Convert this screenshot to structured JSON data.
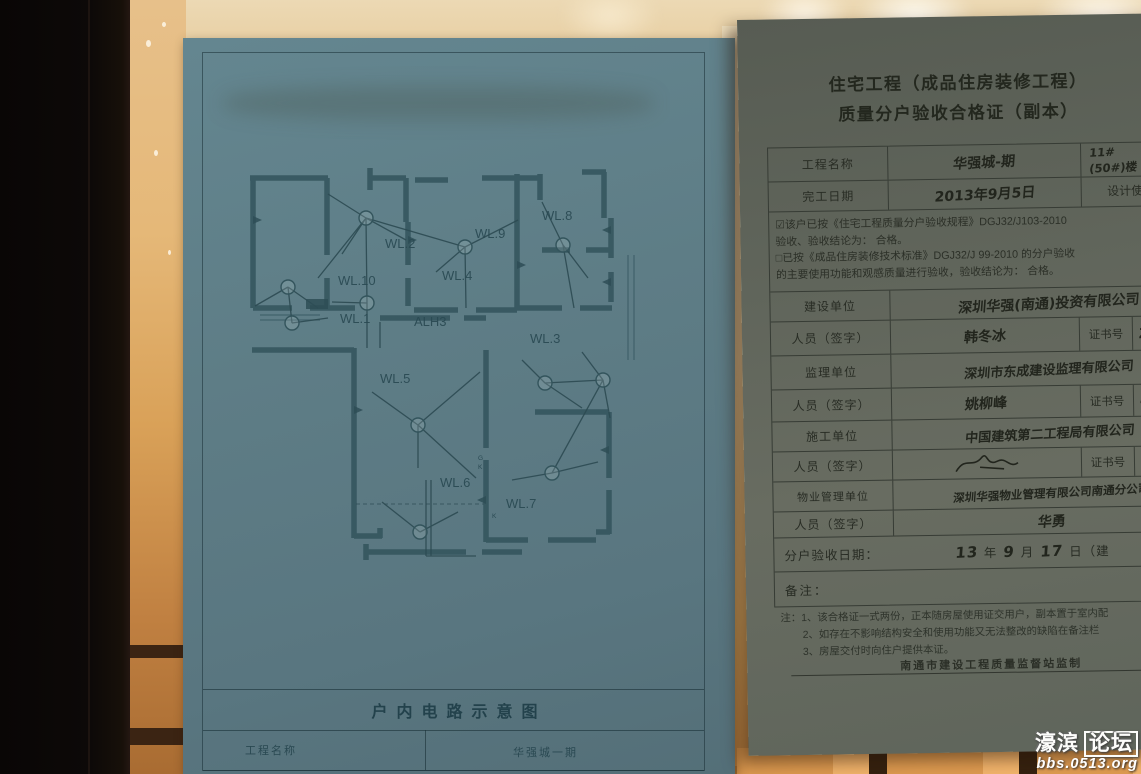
{
  "left_doc": {
    "title": "户内电路示意图",
    "table": {
      "name_label": "工程名称",
      "name_value": "华强城一期"
    },
    "diagram": {
      "labels": [
        {
          "text": "WL.2"
        },
        {
          "text": "WL.9"
        },
        {
          "text": "WL.8"
        },
        {
          "text": "WL.10"
        },
        {
          "text": "WL.4"
        },
        {
          "text": "WL.1"
        },
        {
          "text": "ALH3"
        },
        {
          "text": "WL.3"
        },
        {
          "text": "WL.5"
        },
        {
          "text": "WL.6"
        },
        {
          "text": "WL.7"
        }
      ],
      "marks": {
        "g": "G",
        "k1": "K",
        "k2": "K"
      }
    }
  },
  "right_doc": {
    "title_line1": "住宅工程（成品住房装修工程）",
    "title_line2": "质量分户验收合格证（副本）",
    "rows": {
      "project_label": "工程名称",
      "project_value_hand": "华强城-期",
      "project_unit_line1": "11#",
      "project_unit_line2": "(50#)楼 2 单",
      "finish_label": "完工日期",
      "finish_value_hand": "2013年9月5日",
      "design_life_label": "设计使用年限",
      "builder_label": "建设单位",
      "builder_value_hand": "深圳华强(南通)投资有限公司",
      "person_label": "人员（签字）",
      "builder_person_hand": "韩冬冰",
      "cert_label": "证书号",
      "builder_cert_hand": "ZGD",
      "supervisor_label": "监理单位",
      "supervisor_value_hand": "深圳市东成建设监理有限公司",
      "supervisor_person_hand": "姚柳峰",
      "supervisor_cert_hand": "44",
      "contractor_label": "施工单位",
      "contractor_value_hand": "中国建筑第二工程局有限公司",
      "property_label": "物业管理单位",
      "property_value_hand": "深圳华强物业管理有限公司南通分公司",
      "property_person_hand": "华勇",
      "date_label": "分户验收日期：",
      "date_year_hand": "13",
      "date_year": "年",
      "date_month_hand": "9",
      "date_month": "月",
      "date_day_hand": "17",
      "date_day_suffix": "日（建",
      "remark_label": "备注："
    },
    "checkbox1_mark": "☑",
    "checkbox1_line1": "该户已按《住宅工程质量分户验收规程》DGJ32/J103-2010",
    "checkbox1_line2": "验收、验收结论为：  合格。",
    "checkbox2_mark": "□",
    "checkbox2_line1": "已按《成品住房装修技术标准》DGJ32/J 99-2010 的分户验收",
    "checkbox2_line2": "的主要使用功能和观感质量进行验收，验收结论为：  合格。",
    "notes_line1": "注：1、该合格证一式两份，正本随房屋使用证交用户，副本置于室内配",
    "notes_line2": "2、如存在不影响结构安全和使用功能又无法整改的缺陷在备注栏",
    "notes_line3": "3、房屋交付时向住户提供本证。",
    "footer": "南通市建设工程质量监督站监制"
  },
  "watermark": {
    "part1": "濠滨",
    "part2": "论坛",
    "line2": "bbs.0513.org"
  }
}
